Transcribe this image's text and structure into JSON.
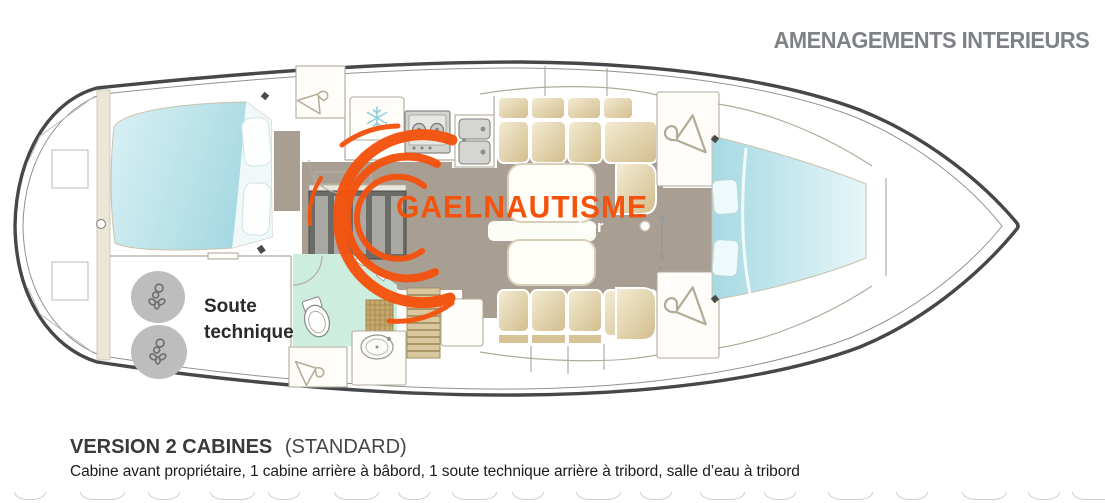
{
  "header": {
    "title": "AMENAGEMENTS INTERIEURS"
  },
  "watermark": {
    "brand": "GAELNAUTISME",
    "partial_tagline": "ker"
  },
  "diagram": {
    "soute_label": "Soute\ntechnique",
    "icons": {
      "hanger-icon": "coat hanger (hanging locker)",
      "snowflake-icon": "fridge / cold box",
      "stove-icon": "two-burner stove",
      "sink-icon": "double galley sink",
      "toilet-icon": "marine toilet",
      "washbasin-icon": "bathroom basin",
      "shower-grate-icon": "teak shower grating",
      "propeller-icon": "engine / technical equipment",
      "porthole-icon": "transom porthole",
      "mast-post-icon": "mast compression post"
    }
  },
  "footer": {
    "version_bold": "VERSION 2 CABINES",
    "version_normal": "(STANDARD)",
    "description": "Cabine avant propriétaire, 1 cabine arrière à bâbord, 1 soute technique arrière à tribord, salle d’eau à tribord"
  },
  "colors": {
    "accent_orange": "#f4530e",
    "title_gray": "#7e8287",
    "text_dark": "#1f1f1f",
    "hull_outline": "#46474a",
    "floor_taupe": "#a89e92",
    "cushion_tan": "#e7d8b2",
    "bed_blue": "#b9e2ea",
    "bath_mint": "#cdeede",
    "teak_wood": "#c7a86b",
    "equipment_gray": "#bdbdbd"
  }
}
